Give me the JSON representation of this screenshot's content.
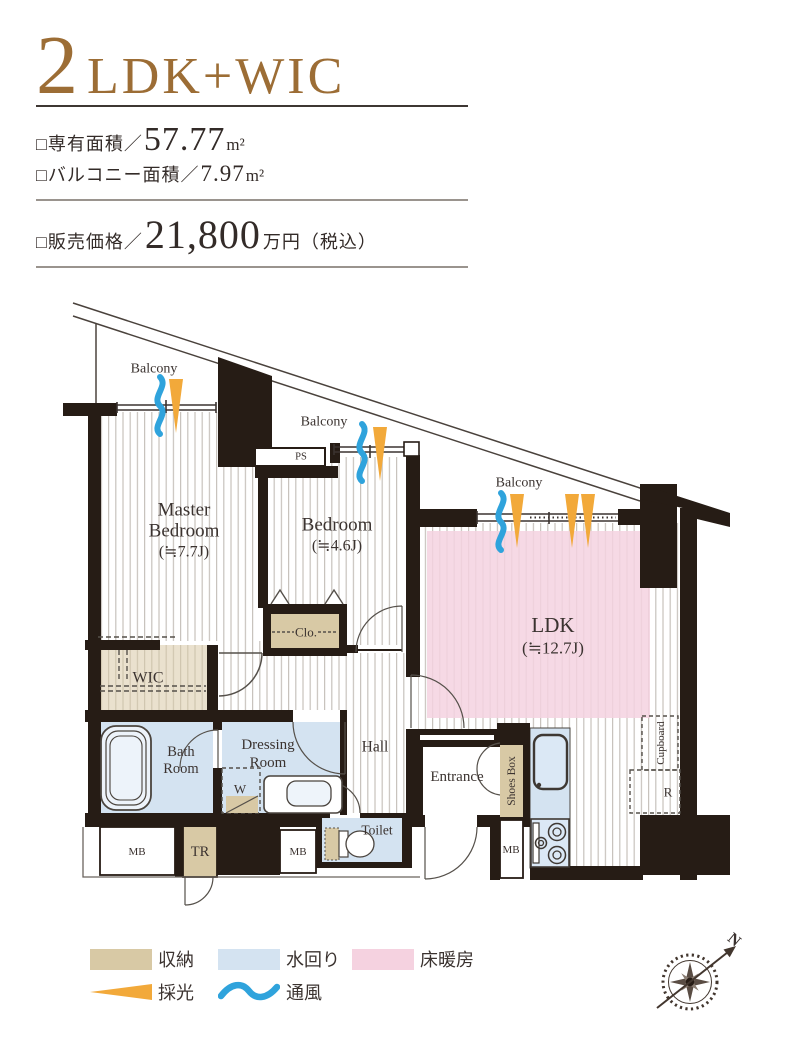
{
  "colors": {
    "wall": "#261c15",
    "storage_tan": "#d8c9a5",
    "water_blue": "#d4e3f1",
    "floor_heating_pink": "#f5d2e0",
    "daylight_orange": "#f2a93a",
    "ventilation_blue": "#2fa3dc",
    "title_brown": "#9c6d35",
    "text_dark": "#3b3330"
  },
  "header": {
    "title_number": "2",
    "title_suffix": "LDK+WIC",
    "area_label": "□専有面積／",
    "area_value": "57.77",
    "area_unit": "m²",
    "balcony_area_label": "□バルコニー面積／",
    "balcony_area_value": "7.97",
    "balcony_area_unit": "m²",
    "price_label": "□販売価格／",
    "price_value": "21,800",
    "price_suffix": "万円（税込）"
  },
  "plan": {
    "balcony1": "Balcony",
    "balcony2": "Balcony",
    "balcony3": "Balcony",
    "master_bedroom_line1": "Master",
    "master_bedroom_line2": "Bedroom",
    "master_bedroom_size": "(≒7.7J)",
    "bedroom_line1": "Bedroom",
    "bedroom_size": "(≒4.6J)",
    "ldk_line1": "LDK",
    "ldk_size": "(≒12.7J)",
    "wic": "WIC",
    "clo": "Clo.",
    "ps": "PS",
    "bath_line1": "Bath",
    "bath_line2": "Room",
    "dressing_line1": "Dressing",
    "dressing_line2": "Room",
    "washer": "W",
    "hall": "Hall",
    "toilet": "Toilet",
    "entrance": "Entrance",
    "shoes_box": "Shoes Box",
    "cupboard": "Cupboard",
    "refrigerator": "R",
    "tr": "TR",
    "mb1": "MB",
    "mb2": "MB",
    "mb3": "MB",
    "compass_north": "N"
  },
  "legend": {
    "storage": "収納",
    "water": "水回り",
    "floor_heating": "床暖房",
    "daylight": "採光",
    "ventilation": "通風"
  }
}
